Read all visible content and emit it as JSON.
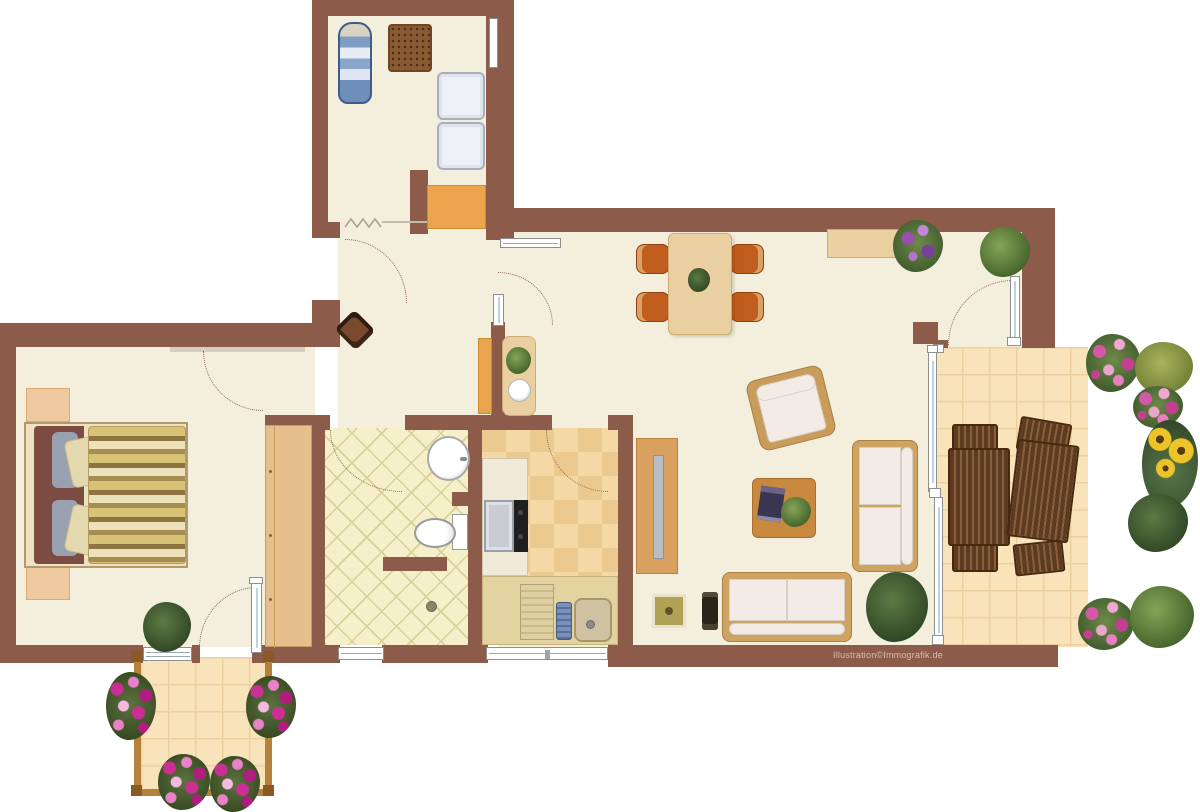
{
  "watermark": "Illustration©Immografik.de",
  "palette": {
    "wall": "#8d5b49",
    "floor_cream": "#f4eedd",
    "bath_tile": "#f5f0ca",
    "kitchen_tile_a": "#f4d9a6",
    "kitchen_tile_b": "#ecc98f",
    "terrace_tile": "#f8e3ba",
    "wood_light": "#ead0a0",
    "wood_dark_slats": "#5d3a20",
    "dining_chair_orange": "#c05c1d",
    "flower_pink": "#d557a8",
    "plant_green": "#6d8f4a",
    "glass_blue": "#b8d4e4"
  },
  "plan": {
    "type": "apartment-floor-plan-top-view",
    "rooms": [
      {
        "name": "utility-room",
        "position": "top-left-wing",
        "furniture": [
          "ironing-board",
          "drying-rack",
          "washing-machine",
          "dryer",
          "wood-shelf",
          "wall-niche"
        ]
      },
      {
        "name": "hallway",
        "position": "center-left",
        "furniture": [
          "cat-on-cushion",
          "shoe-shelf",
          "console-table",
          "console-plant",
          "decorative-bowl"
        ],
        "doors": [
          "entry-zigzag",
          "swing-arcs"
        ]
      },
      {
        "name": "bedroom",
        "position": "left",
        "furniture": [
          "double-bed-striped-duvet",
          "nightstand-top",
          "nightstand-bottom",
          "wardrobe",
          "floor-plant"
        ],
        "openings": [
          "door-to-hall",
          "window-bottom",
          "glass-door-to-balcony"
        ]
      },
      {
        "name": "bathroom",
        "position": "center",
        "furniture": [
          "round-washbasin",
          "toilet",
          "shower-drain"
        ],
        "openings": [
          "door-to-hall",
          "window-bottom"
        ]
      },
      {
        "name": "kitchen",
        "position": "center",
        "furniture": [
          "counter-left",
          "oven",
          "cooktop",
          "counter-bottom",
          "drainboard",
          "dish-rack",
          "sink-basin"
        ],
        "openings": [
          "door-to-living",
          "window-bottom"
        ]
      },
      {
        "name": "living-dining-room",
        "position": "center-right",
        "furniture": [
          "dining-table",
          "dining-chairs-x4",
          "table-plant",
          "radiator",
          "sideboard",
          "sideboard-plant-purple",
          "corner-plant",
          "tv-lowboard",
          "flat-tv",
          "armchair",
          "coffee-table",
          "magazine",
          "coffee-table-plant",
          "sofa-two-seat-vertical",
          "sofa-two-seat-horizontal",
          "stool-square",
          "small-device",
          "large-plant"
        ],
        "openings": [
          "glass-door-to-terrace",
          "glass-wall-to-terrace"
        ]
      },
      {
        "name": "terrace",
        "position": "right",
        "furniture": [
          "slatted-table-left",
          "slatted-table-right",
          "garden-chair-x4",
          "pink-bush-x3",
          "olive-bush",
          "green-bush",
          "sunflowers",
          "leafy-plant"
        ]
      },
      {
        "name": "balcony",
        "position": "bottom-left",
        "furniture": [
          "wood-railing",
          "flower-box-left",
          "flower-box-right",
          "flower-box-bottom-left",
          "flower-box-bottom-right"
        ]
      }
    ]
  }
}
